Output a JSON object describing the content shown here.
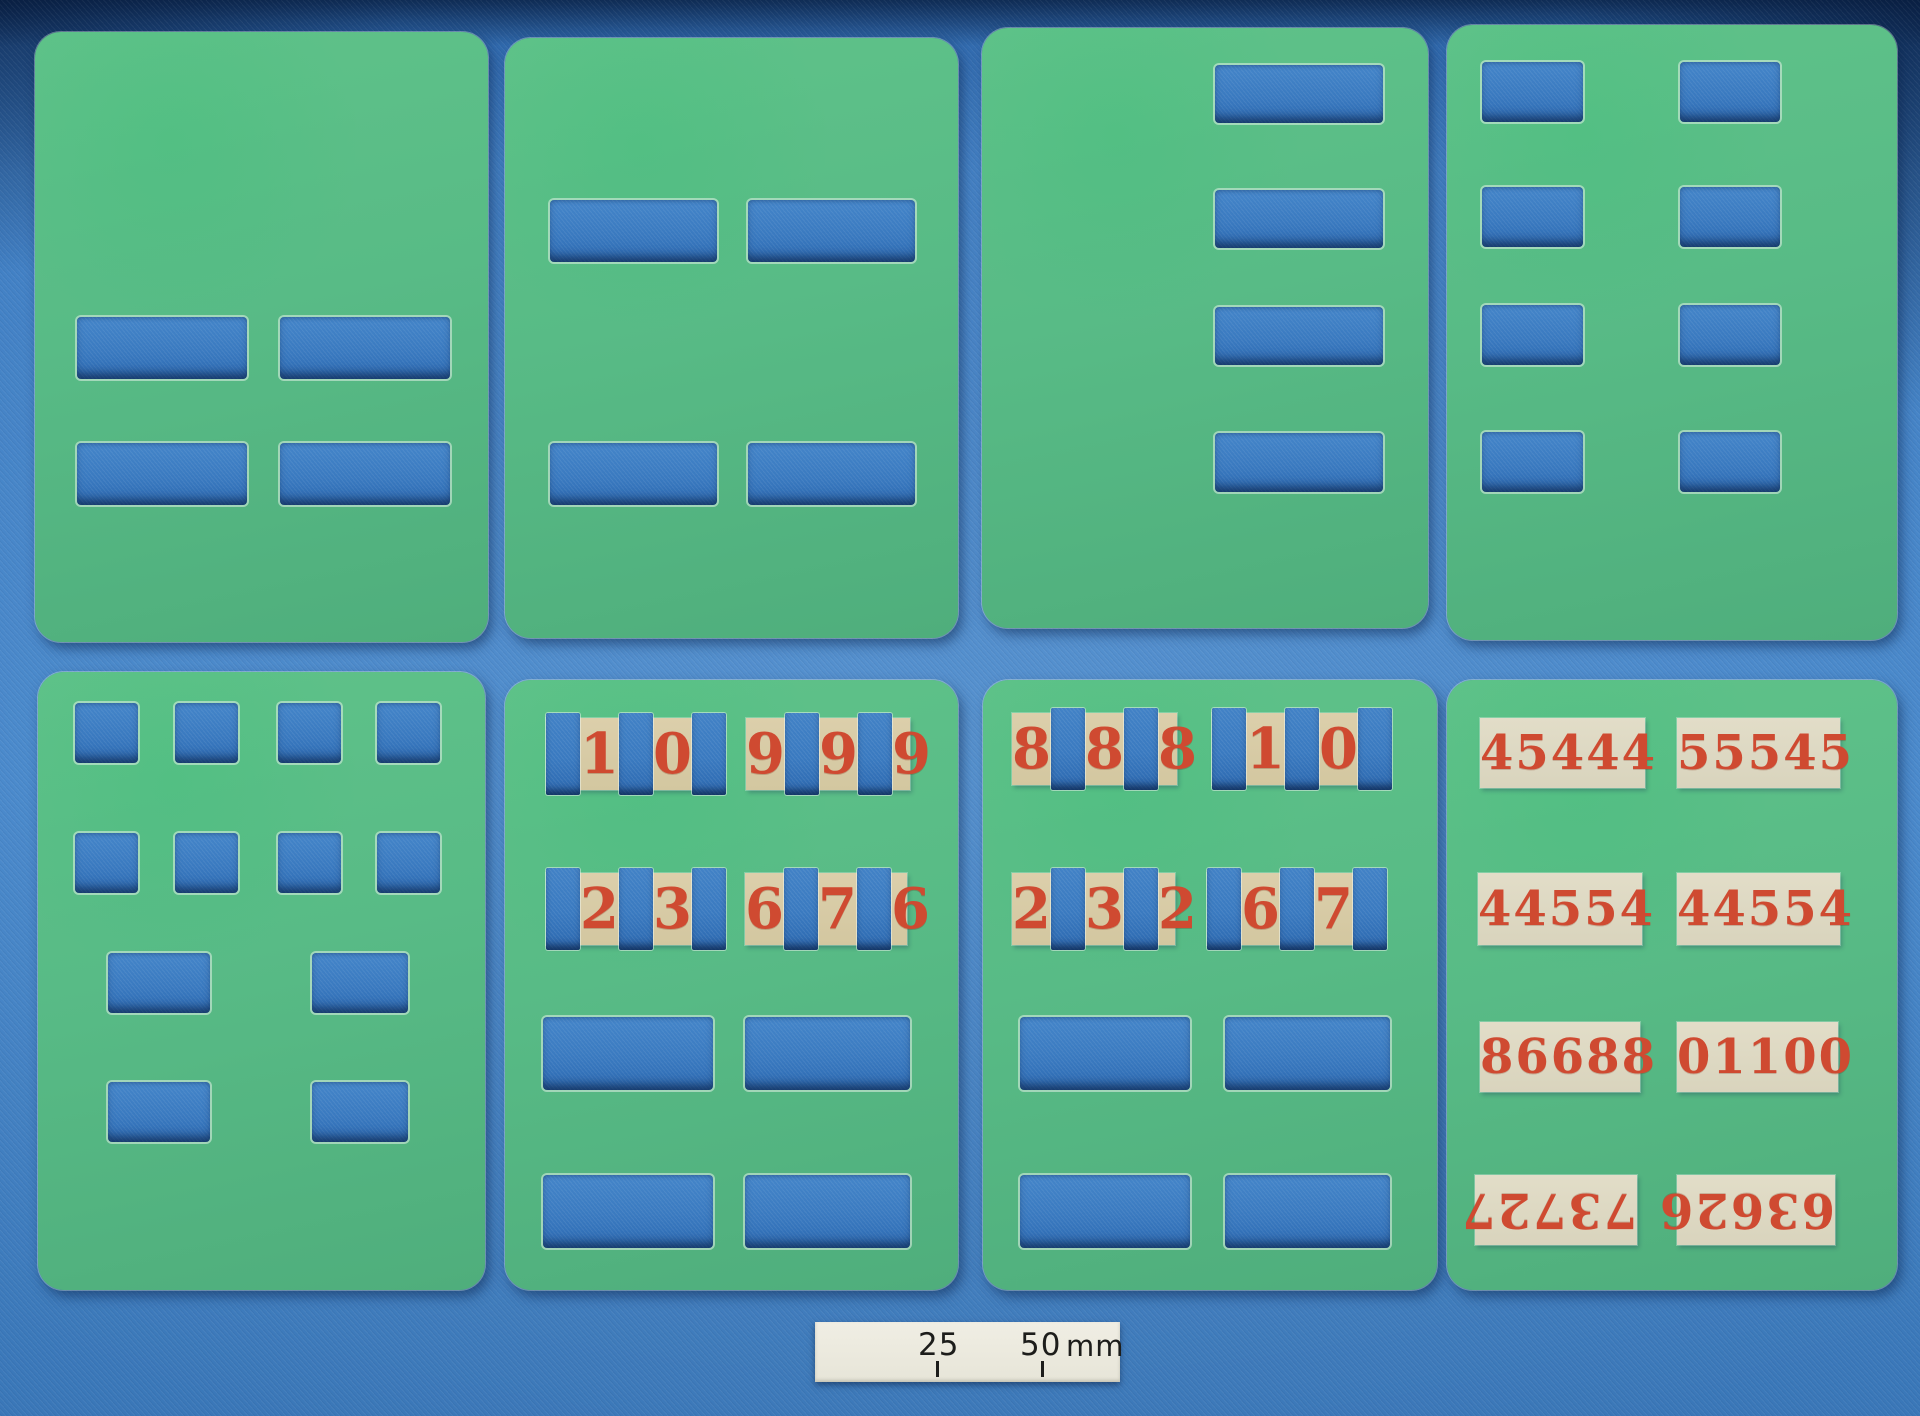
{
  "colors": {
    "fabric": "#3f7ec3",
    "fabric_dark": "#2a62a6",
    "cutout": "#3a7ac0",
    "card_light": "#5fc289",
    "card_dark": "#4fae7c",
    "strip_tan": "#d3c7a0",
    "strip_cream": "#d9d4bd",
    "digit_red": "#cf4a31",
    "scale_bg": "#e7e5d8",
    "scale_text": "#1d1d1b"
  },
  "cards": [
    {
      "name": "stencil-card-top-left",
      "x": 35,
      "y": 32,
      "w": 453,
      "h": 610,
      "cutouts": [
        {
          "x": 42,
          "y": 285,
          "w": 170,
          "h": 62
        },
        {
          "x": 245,
          "y": 285,
          "w": 170,
          "h": 62
        },
        {
          "x": 42,
          "y": 411,
          "w": 170,
          "h": 62
        },
        {
          "x": 245,
          "y": 411,
          "w": 170,
          "h": 62
        }
      ]
    },
    {
      "name": "stencil-card-top-2",
      "x": 505,
      "y": 38,
      "w": 453,
      "h": 600,
      "cutouts": [
        {
          "x": 45,
          "y": 162,
          "w": 167,
          "h": 62
        },
        {
          "x": 243,
          "y": 162,
          "w": 167,
          "h": 62
        },
        {
          "x": 45,
          "y": 405,
          "w": 167,
          "h": 62
        },
        {
          "x": 243,
          "y": 405,
          "w": 167,
          "h": 62
        }
      ]
    },
    {
      "name": "stencil-card-top-3",
      "x": 982,
      "y": 28,
      "w": 446,
      "h": 600,
      "cutouts": [
        {
          "x": 233,
          "y": 37,
          "w": 168,
          "h": 58
        },
        {
          "x": 233,
          "y": 162,
          "w": 168,
          "h": 58
        },
        {
          "x": 233,
          "y": 279,
          "w": 168,
          "h": 58
        },
        {
          "x": 233,
          "y": 405,
          "w": 168,
          "h": 59
        }
      ]
    },
    {
      "name": "stencil-card-top-right",
      "x": 1447,
      "y": 25,
      "w": 450,
      "h": 615,
      "cutouts": [
        {
          "x": 35,
          "y": 37,
          "w": 101,
          "h": 60
        },
        {
          "x": 233,
          "y": 37,
          "w": 100,
          "h": 60
        },
        {
          "x": 35,
          "y": 162,
          "w": 101,
          "h": 60
        },
        {
          "x": 233,
          "y": 162,
          "w": 100,
          "h": 60
        },
        {
          "x": 35,
          "y": 280,
          "w": 101,
          "h": 60
        },
        {
          "x": 233,
          "y": 280,
          "w": 100,
          "h": 60
        },
        {
          "x": 35,
          "y": 407,
          "w": 101,
          "h": 60
        },
        {
          "x": 233,
          "y": 407,
          "w": 100,
          "h": 60
        }
      ]
    },
    {
      "name": "stencil-card-bottom-left",
      "x": 38,
      "y": 672,
      "w": 447,
      "h": 618,
      "cutouts": [
        {
          "x": 37,
          "y": 31,
          "w": 63,
          "h": 60
        },
        {
          "x": 137,
          "y": 31,
          "w": 63,
          "h": 60
        },
        {
          "x": 240,
          "y": 31,
          "w": 63,
          "h": 60
        },
        {
          "x": 339,
          "y": 31,
          "w": 63,
          "h": 60
        },
        {
          "x": 37,
          "y": 161,
          "w": 63,
          "h": 60
        },
        {
          "x": 137,
          "y": 161,
          "w": 63,
          "h": 60
        },
        {
          "x": 240,
          "y": 161,
          "w": 63,
          "h": 60
        },
        {
          "x": 339,
          "y": 161,
          "w": 63,
          "h": 60
        },
        {
          "x": 70,
          "y": 281,
          "w": 102,
          "h": 60
        },
        {
          "x": 274,
          "y": 281,
          "w": 96,
          "h": 60
        },
        {
          "x": 70,
          "y": 410,
          "w": 102,
          "h": 60
        },
        {
          "x": 274,
          "y": 410,
          "w": 96,
          "h": 60
        }
      ]
    },
    {
      "name": "number-card-bottom-2",
      "x": 505,
      "y": 680,
      "w": 453,
      "h": 610,
      "cutouts": [
        {
          "x": 38,
          "y": 337,
          "w": 170,
          "h": 73
        },
        {
          "x": 240,
          "y": 337,
          "w": 165,
          "h": 73
        },
        {
          "x": 38,
          "y": 495,
          "w": 170,
          "h": 73
        },
        {
          "x": 240,
          "y": 495,
          "w": 165,
          "h": 73
        }
      ],
      "strips": [
        {
          "x": 41,
          "y": 38,
          "w": 170,
          "h": 72,
          "tone": "tan",
          "cells": [
            "slot",
            "1",
            "slot",
            "0",
            "slot"
          ]
        },
        {
          "x": 241,
          "y": 38,
          "w": 164,
          "h": 72,
          "tone": "tan",
          "cells": [
            "9",
            "slot",
            "9",
            "slot",
            "9"
          ]
        },
        {
          "x": 41,
          "y": 193,
          "w": 170,
          "h": 72,
          "tone": "tan",
          "cells": [
            "slot",
            "2",
            "slot",
            "3",
            "slot"
          ]
        },
        {
          "x": 240,
          "y": 193,
          "w": 162,
          "h": 72,
          "tone": "tan",
          "cells": [
            "6",
            "slot",
            "7",
            "slot",
            "6"
          ]
        }
      ]
    },
    {
      "name": "number-card-bottom-3",
      "x": 983,
      "y": 680,
      "w": 454,
      "h": 610,
      "cutouts": [
        {
          "x": 37,
          "y": 337,
          "w": 170,
          "h": 73
        },
        {
          "x": 242,
          "y": 337,
          "w": 165,
          "h": 73
        },
        {
          "x": 37,
          "y": 495,
          "w": 170,
          "h": 73
        },
        {
          "x": 242,
          "y": 495,
          "w": 165,
          "h": 73
        }
      ],
      "strips": [
        {
          "x": 29,
          "y": 33,
          "w": 165,
          "h": 72,
          "tone": "tan",
          "cells": [
            "8",
            "slot",
            "8",
            "slot",
            "8"
          ]
        },
        {
          "x": 229,
          "y": 33,
          "w": 166,
          "h": 72,
          "tone": "tan",
          "cells": [
            "slot",
            "1",
            "slot",
            "0",
            "slot"
          ]
        },
        {
          "x": 29,
          "y": 193,
          "w": 163,
          "h": 72,
          "tone": "tan",
          "cells": [
            "2",
            "slot",
            "3",
            "slot",
            "2"
          ]
        },
        {
          "x": 224,
          "y": 193,
          "w": 168,
          "h": 72,
          "tone": "tan",
          "cells": [
            "slot",
            "6",
            "slot",
            "7",
            "slot"
          ]
        }
      ]
    },
    {
      "name": "number-card-bottom-right",
      "x": 1447,
      "y": 680,
      "w": 450,
      "h": 610,
      "strips": [
        {
          "x": 33,
          "y": 38,
          "w": 165,
          "h": 70,
          "tone": "cream",
          "text": "45444"
        },
        {
          "x": 230,
          "y": 38,
          "w": 163,
          "h": 70,
          "tone": "cream",
          "text": "55545"
        },
        {
          "x": 31,
          "y": 193,
          "w": 164,
          "h": 72,
          "tone": "cream",
          "text": "44554"
        },
        {
          "x": 230,
          "y": 193,
          "w": 163,
          "h": 72,
          "tone": "cream",
          "text": "44554"
        },
        {
          "x": 33,
          "y": 342,
          "w": 160,
          "h": 70,
          "tone": "cream",
          "text": "86688"
        },
        {
          "x": 230,
          "y": 342,
          "w": 161,
          "h": 70,
          "tone": "cream",
          "text": "01100"
        },
        {
          "x": 28,
          "y": 495,
          "w": 162,
          "h": 70,
          "tone": "cream",
          "text": "73727",
          "rotated": true
        },
        {
          "x": 230,
          "y": 495,
          "w": 158,
          "h": 70,
          "tone": "cream",
          "text": "63626",
          "rotated": true
        }
      ]
    }
  ],
  "scale_bar": {
    "x": 815,
    "y": 1322,
    "w": 305,
    "h": 60,
    "left_label": "25",
    "right_label": "50",
    "unit": "mm"
  }
}
